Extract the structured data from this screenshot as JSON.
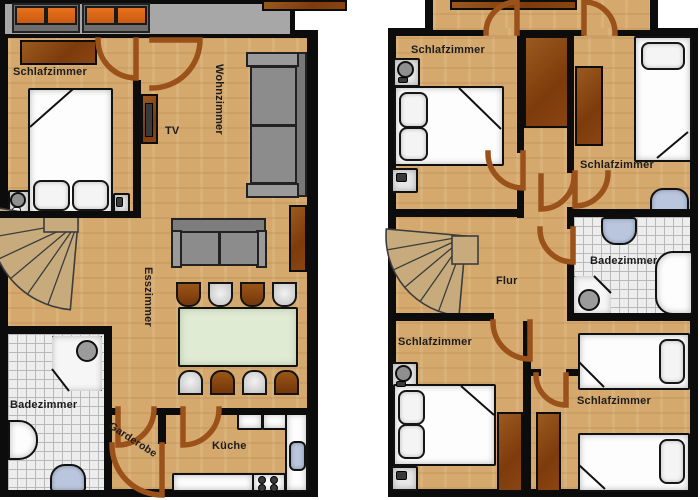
{
  "left": {
    "labels": {
      "schlafzimmer": "Schlafzimmer",
      "wohnzimmer": "Wohnzimmer",
      "tv": "TV",
      "esszimmer": "Esszimmer",
      "badezimmer": "Badezimmer",
      "garderobe": "Garderobe",
      "kueche": "Küche"
    }
  },
  "right": {
    "labels": {
      "schlafzimmer_nw": "Schlafzimmer",
      "schlafzimmer_ne": "Schlafzimmer",
      "badezimmer": "Badezimmer",
      "flur": "Flur",
      "schlafzimmer_sw": "Schlafzimmer",
      "schlafzimmer_se": "Schlafzimmer"
    }
  },
  "colors": {
    "wood": "#d5a96e",
    "wall": "#0c0c0c",
    "furniture_brown": "#8a4511",
    "door_brown": "#9a521a",
    "balcony_gray": "#a7a7a7",
    "cushion_orange": "#dc6a1a",
    "sofa_gray": "#8c8c8c",
    "table_green": "#e0ebd4",
    "fixture_blue": "#b9c6dd",
    "tile_gray": "#ededed",
    "stairs_tan": "#c7ab7c",
    "text": "#1c1c1c"
  },
  "symbols": {
    "door": "quarter-circle-swing",
    "stairs": "spiral-fan"
  }
}
